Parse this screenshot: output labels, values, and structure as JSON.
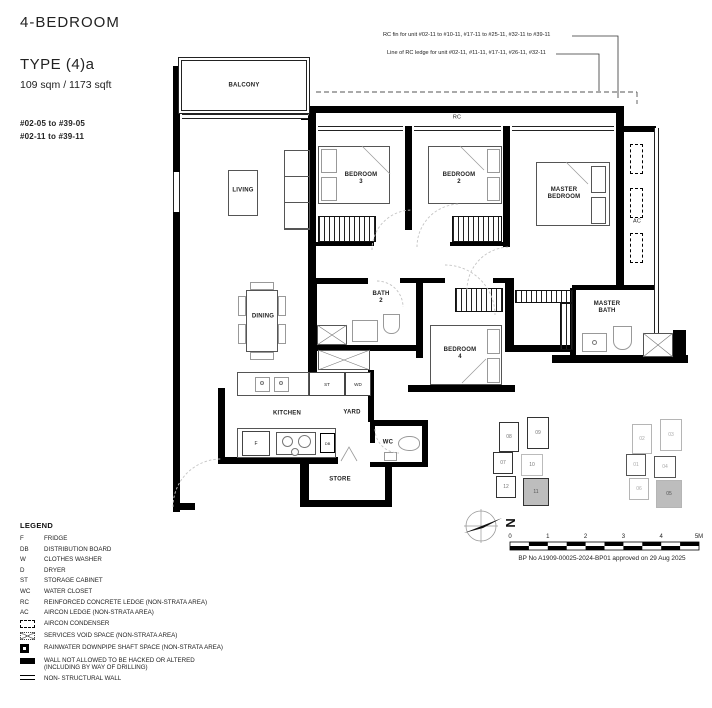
{
  "title_block": {
    "category": "4-BEDROOM",
    "type_name": "TYPE (4)a",
    "area": "109 sqm / 1173 sqft",
    "unit_ranges": [
      "#02-05 to #39-05",
      "#02-11 to #39-11"
    ]
  },
  "annotations": {
    "rc_fin": "RC fin for unit #02-11 to #10-11, #17-11 to #25-11, #32-11 to #39-11",
    "rc_ledge": "Line of RC ledge for unit #02-11, #11-11, #17-11, #26-11, #32-11"
  },
  "rooms": {
    "balcony": "BALCONY",
    "living": "LIVING",
    "dining": "DINING",
    "kitchen": "KITCHEN",
    "yard": "YARD",
    "store": "STORE",
    "wc": "WC",
    "bath2": "BATH\n2",
    "bedroom3": "BEDROOM\n3",
    "bedroom2": "BEDROOM\n2",
    "bedroom4": "BEDROOM\n4",
    "master_bedroom": "MASTER\nBEDROOM",
    "master_bath": "MASTER\nBATH"
  },
  "plan_marks": {
    "rc": "RC",
    "ac": "AC",
    "st": "ST",
    "wd": "WD",
    "f": "F",
    "db": "DB"
  },
  "legend": {
    "heading": "LEGEND",
    "abbr_items": [
      {
        "key": "F",
        "text": "FRIDGE"
      },
      {
        "key": "DB",
        "text": "DISTRIBUTION BOARD"
      },
      {
        "key": "W",
        "text": "CLOTHES WASHER"
      },
      {
        "key": "D",
        "text": "DRYER"
      },
      {
        "key": "ST",
        "text": "STORAGE CABINET"
      },
      {
        "key": "WC",
        "text": "WATER CLOSET"
      },
      {
        "key": "RC",
        "text": "REINFORCED CONCRETE LEDGE (NON-STRATA AREA)"
      },
      {
        "key": "AC",
        "text": "AIRCON LEDGE (NON-STRATA AREA)"
      }
    ],
    "symbol_items": [
      {
        "icon": "aircon-condenser-icon",
        "text": "AIRCON CONDENSER"
      },
      {
        "icon": "services-void-icon",
        "text": "SERVICES VOID SPACE (NON-STRATA AREA)"
      },
      {
        "icon": "rainwater-downpipe-icon",
        "text": "RAINWATER DOWNPIPE SHAFT SPACE (NON-STRATA AREA)"
      },
      {
        "icon": "hack-wall-icon",
        "text": "WALL NOT ALLOWED TO BE HACKED OR ALTERED\n(INCLUDING BY WAY OF DRILLING)"
      },
      {
        "icon": "non-structural-wall-icon",
        "text": "NON- STRUCTURAL WALL"
      }
    ]
  },
  "scale_bar": {
    "labels": [
      "0",
      "1",
      "2",
      "3",
      "4",
      "5M"
    ]
  },
  "approval": "BP No A1909-00025-2024-BP01 approved on 29 Aug 2025",
  "north": {
    "label": "N"
  },
  "key_plans": {
    "left": {
      "units": [
        "08",
        "09",
        "07",
        "10",
        "12",
        "11"
      ],
      "highlighted": "11"
    },
    "right": {
      "units": [
        "02",
        "03",
        "01",
        "04",
        "06",
        "05"
      ],
      "highlighted": "05"
    }
  }
}
